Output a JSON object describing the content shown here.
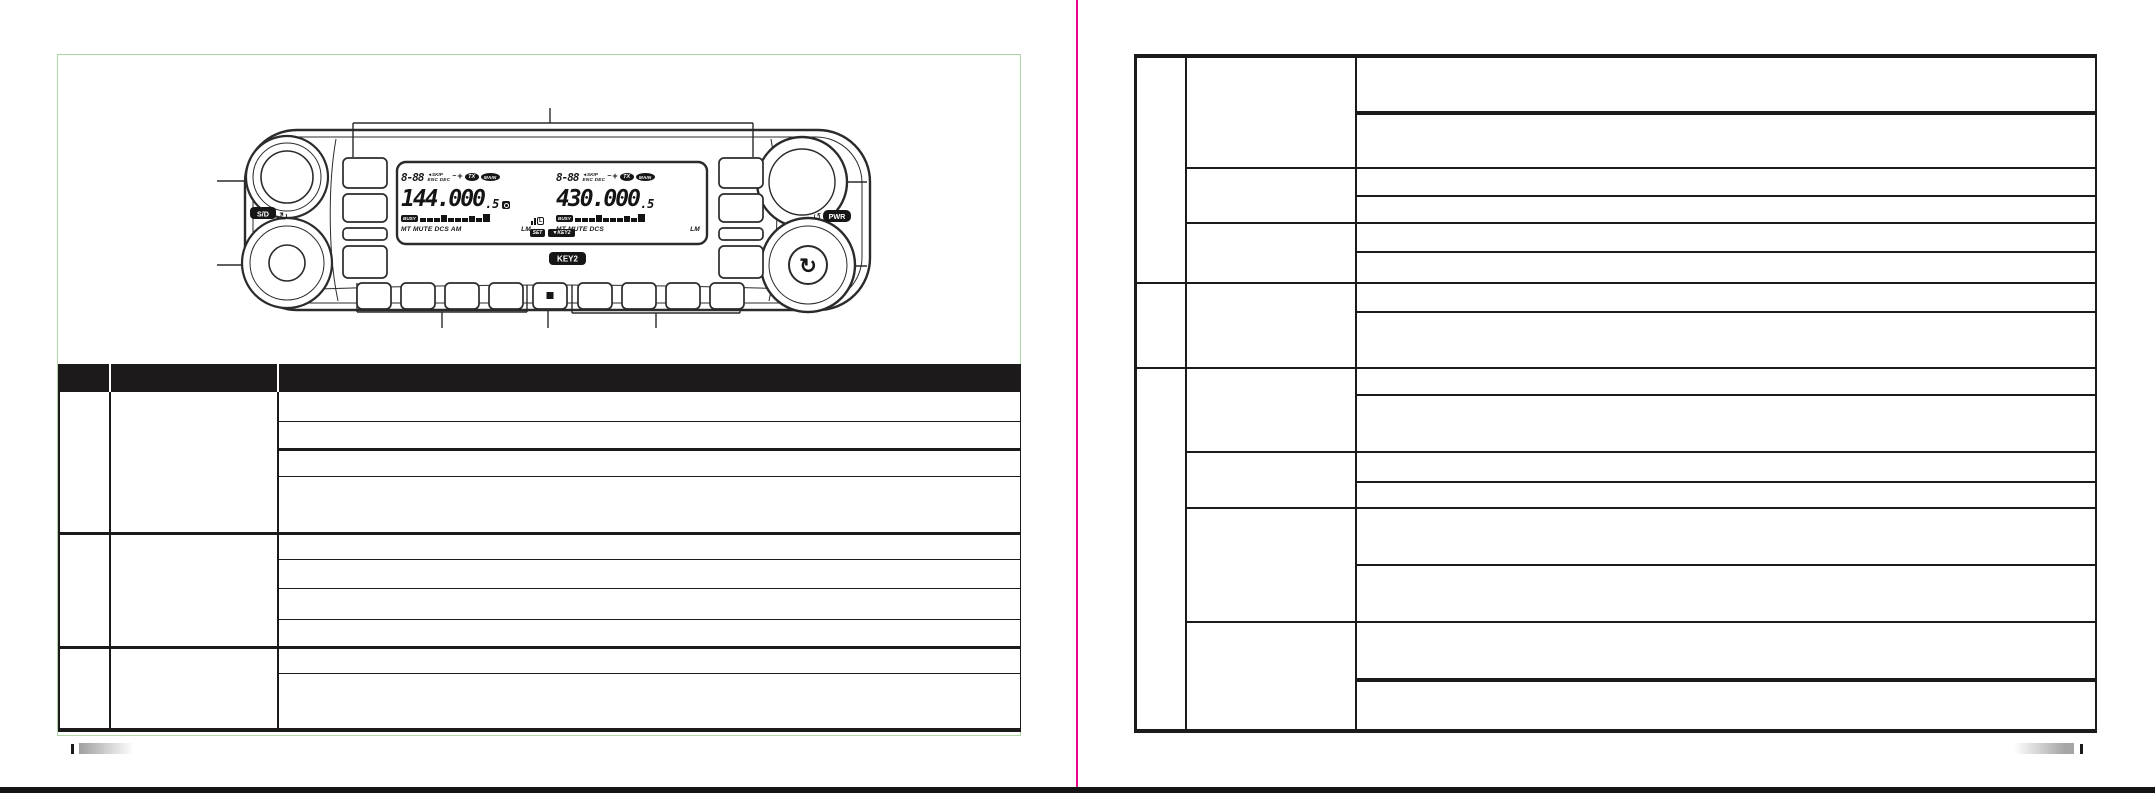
{
  "radio_panel": {
    "sd_knob_badge": "S/D",
    "pwr_knob_badge": "PWR",
    "key2_button_badge": "KEY2",
    "lcd": {
      "left_band": {
        "memory_channel": "8-88",
        "skip_flag": "◄SKIP",
        "enc_flag": "ENC",
        "dec_flag": "DEC",
        "shift_minus": "−",
        "shift_plus": "+",
        "tx_badge": "TX",
        "main_badge": "MAIN",
        "frequency": "144.000",
        "frequency_sub_digit": ".5",
        "busy_badge": "BUSY",
        "status_labels": "MT MUTE DCS AM",
        "level_label": "LM"
      },
      "right_band": {
        "memory_channel": "8-88",
        "skip_flag": "◄SKIP",
        "enc_flag": "ENC",
        "dec_flag": "DEC",
        "shift_minus": "−",
        "shift_plus": "+",
        "tx_badge": "TX",
        "main_badge": "MAIN",
        "frequency": "430.000",
        "frequency_sub_digit": ".5",
        "busy_badge": "BUSY",
        "status_labels": "MT MUTE DCS",
        "level_label": "LM"
      },
      "center": {
        "set_badge": "SET",
        "key2_badge": "▼KEY2",
        "lock_label": "L"
      }
    }
  },
  "colors": {
    "separator_magenta": "#ec008c",
    "figure_border_green": "#aed6a6",
    "line_black": "#1c1a1b",
    "footer_gray": "#a8a8a8"
  }
}
